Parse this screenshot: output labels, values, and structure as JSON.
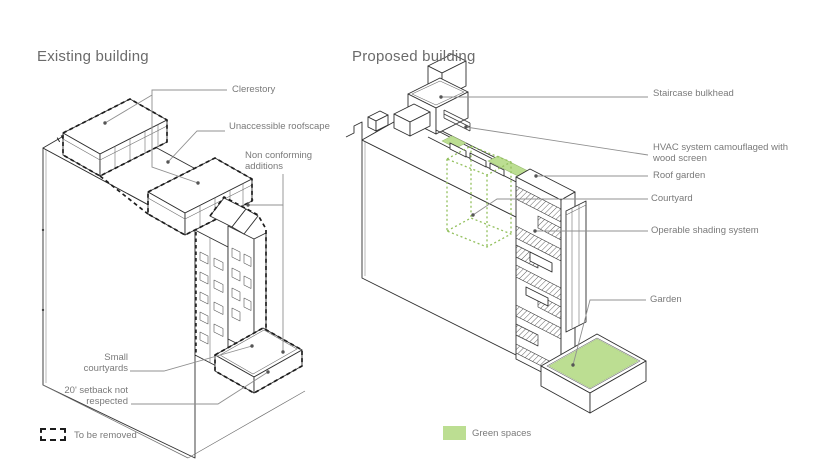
{
  "page": {
    "type": "architectural-diagram",
    "background": "#ffffff"
  },
  "colors": {
    "green_fill": "#bcde92",
    "green_dotted": "#93c05e",
    "line_dark": "#2f2f2f",
    "line_light": "#6d6d6d",
    "leader_gray": "#909090",
    "text_gray": "#7a7a7a",
    "title_gray": "#6b6b6b",
    "dashed_removal": "#1c1c1c"
  },
  "existing": {
    "title": "Existing building",
    "labels": {
      "clerestory": "Clerestory",
      "roofscape": "Unaccessible roofscape",
      "nonconforming": "Non conforming additions",
      "small_courtyards": "Small courtyards",
      "setback": "20' setback not respected"
    },
    "legend": {
      "label": "To be removed"
    }
  },
  "proposed": {
    "title": "Proposed building",
    "labels": {
      "staircase": "Staircase bulkhead",
      "hvac": "HVAC system camouflaged with wood screen",
      "roof_garden": "Roof garden",
      "courtyard": "Courtyard",
      "shading": "Operable shading system",
      "garden": "Garden"
    },
    "legend": {
      "label": "Green spaces"
    }
  }
}
